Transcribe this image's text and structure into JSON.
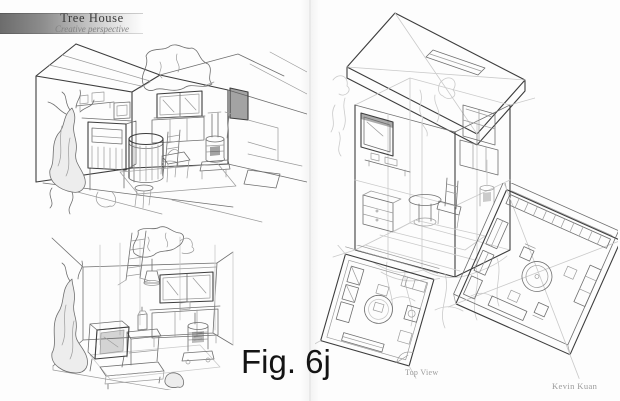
{
  "document": {
    "header": {
      "title": "Tree House",
      "subtitle": "Creative perspective"
    },
    "figure": {
      "caption": "Fig. 6j"
    },
    "labels": {
      "top_view": "Top View",
      "signature": "Kevin Kuan"
    },
    "colors": {
      "page_background": "#fdfdfd",
      "banner_gradient_start": "#6c6c6c",
      "banner_gradient_end": "#f5f5f5",
      "pencil_dark": "#3d3d3d",
      "pencil_mid": "#6f6f6f",
      "pencil_light": "#9b9b9b",
      "pencil_faint": "#cacaca",
      "caption_color": "#141414",
      "label_color": "#9c9c9c"
    },
    "sketches": [
      {
        "id": "interior-perspective-main",
        "label": "Interior perspective sketch: tree-house room with gabled ceiling, branch through roof, tree trunk, shelf, picture frame, window, cabinet, round slatted table with stools, chair and wood stove"
      },
      {
        "id": "interior-perspective-loose",
        "label": "Loose interior sketch: ladder, tree trunk, hanging lamp, window over sideboard, lantern table, TV cabinet, bench and wood stove"
      },
      {
        "id": "cutaway-cube-tree-house",
        "label": "Transparent cutaway cube tree house with flat roof slab and skylight, window, furnished interior, perched on a faint tree trunk"
      },
      {
        "id": "floor-plan-top-view",
        "label": "Tilted top-view floor plan with round table, bench, cabinets and stove"
      },
      {
        "id": "axonometric-cutaway",
        "label": "High-angle axonometric cutaway of the furnished room with round table, chairs and wall shelving"
      }
    ]
  }
}
